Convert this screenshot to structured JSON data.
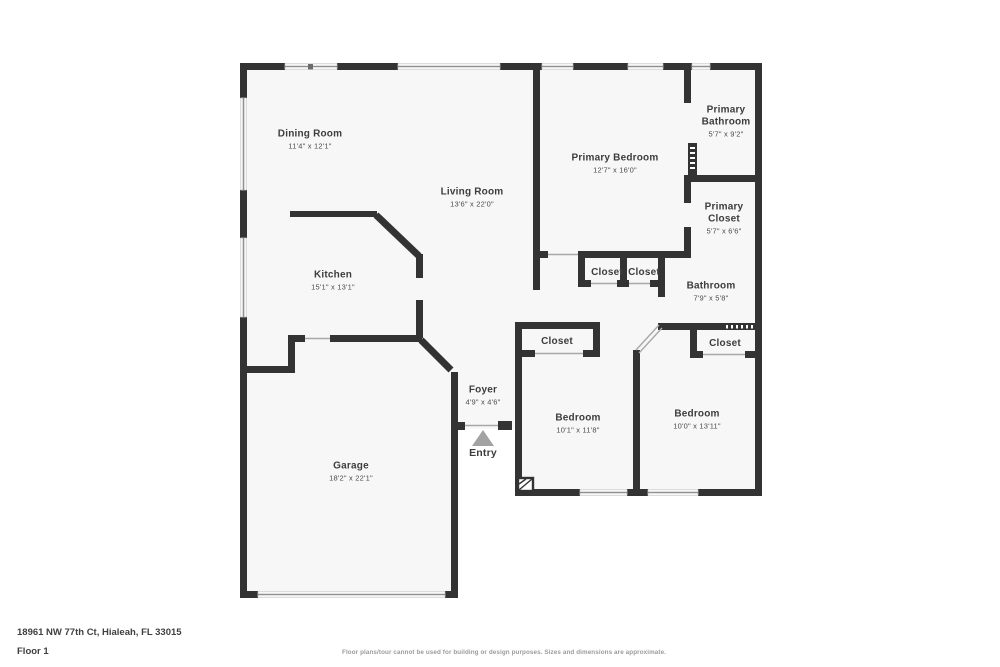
{
  "floorplan": {
    "rooms": {
      "dining": {
        "name": "Dining Room",
        "dims": "11'4\" x 12'1\""
      },
      "living": {
        "name": "Living Room",
        "dims": "13'6\" x 22'0\""
      },
      "kitchen": {
        "name": "Kitchen",
        "dims": "15'1\" x 13'1\""
      },
      "garage": {
        "name": "Garage",
        "dims": "18'2\" x 22'1\""
      },
      "primary_bedroom": {
        "name": "Primary Bedroom",
        "dims": "12'7\" x 16'0\""
      },
      "primary_bathroom": {
        "name": "Primary Bathroom",
        "dims": "5'7\" x 9'2\""
      },
      "primary_closet": {
        "name": "Primary Closet",
        "dims": "5'7\" x 6'6\""
      },
      "bathroom": {
        "name": "Bathroom",
        "dims": "7'9\" x 5'8\""
      },
      "bedroom_1": {
        "name": "Bedroom",
        "dims": "10'1\" x 11'8\""
      },
      "bedroom_2": {
        "name": "Bedroom",
        "dims": "10'0\" x 13'11\""
      },
      "foyer": {
        "name": "Foyer",
        "dims": "4'9\" x 4'6\""
      },
      "hall_closet_left": {
        "name": "Closet"
      },
      "hall_closet_right": {
        "name": "Closet"
      },
      "bedroom_1_closet": {
        "name": "Closet"
      },
      "bedroom_2_closet": {
        "name": "Closet"
      }
    },
    "entry_label": "Entry"
  },
  "footer": {
    "address": "18961 NW 77th Ct, Hialeah, FL 33015",
    "floor": "Floor 1",
    "disclaimer": "Floor plans/tour cannot be used for building or design purposes. Sizes and dimensions are approximate."
  },
  "colors": {
    "wall": "#333333",
    "floor": "#f7f7f7",
    "text": "#3d3d3d",
    "muted": "#9b9b9b",
    "arrow": "#a3a3a3"
  }
}
